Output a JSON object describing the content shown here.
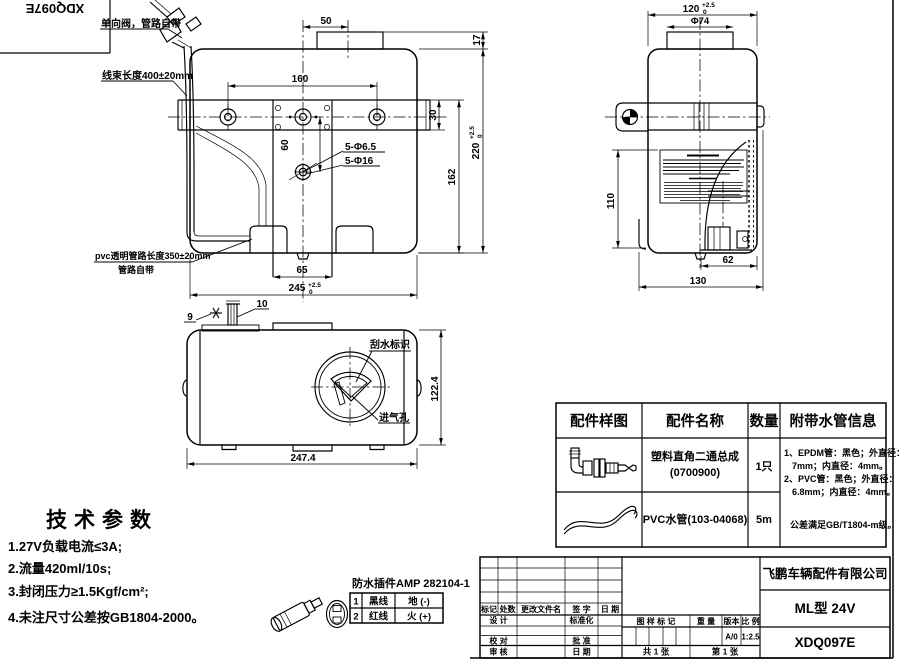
{
  "drawing": {
    "flipped_number": "XDQ097E"
  },
  "callouts": {
    "check_valve": "单向阀，管路自带",
    "harness_length": "线束长度400±20mm",
    "pvc_pipe_line1": "pvc透明管路长度350±20mm",
    "pvc_pipe_line2": "管路自带",
    "wiper_mark": "刮水标识",
    "air_vent": "进气孔"
  },
  "dims": {
    "tol_up": "+2.5",
    "tol_dn": "0",
    "front": {
      "cap_offset": "50",
      "cap_height": "17",
      "hole_spacing": "160",
      "bracket_width": "30",
      "plate_hole_spacing": "60",
      "holes_small": "5-Φ6.5",
      "holes_large": "5-Φ16",
      "body_height": "162",
      "total_height": "220",
      "foot_width": "65",
      "total_width": "245"
    },
    "side": {
      "width": "120",
      "cap_dia": "Φ74",
      "pump_height": "110",
      "outlet_offset": "62",
      "base_width": "130"
    },
    "top": {
      "bracket_a": "9",
      "bracket_b": "10",
      "length": "247.4",
      "depth": "122.4"
    }
  },
  "tech": {
    "title": "技术参数",
    "items": [
      "1.27V负载电流≤3A;",
      "2.流量420ml/10s;",
      "3.封闭压力≥1.5Kgf/cm²;",
      "4.未注尺寸公差按GB1804-2000。"
    ]
  },
  "connector": {
    "title": "防水插件AMP 282104-1",
    "pins": [
      {
        "no": "1",
        "wire": "黑线",
        "polarity": "地 (-)"
      },
      {
        "no": "2",
        "wire": "红线",
        "polarity": "火 (+)"
      }
    ]
  },
  "parts": {
    "headers": [
      "配件样图",
      "配件名称",
      "数量",
      "附带水管信息"
    ],
    "rows": [
      {
        "name_line1": "塑料直角二通总成",
        "name_line2": "(0700900)",
        "qty": "1只"
      },
      {
        "name_line1": "PVC水管(103-04068)",
        "name_line2": "",
        "qty": "5m"
      }
    ],
    "hose_info": [
      "1、EPDM管：黑色；外直径：",
      "7mm；内直径：4mm。",
      "2、PVC管：黑色；外直径：",
      "6.8mm；内直径：4mm。",
      "公差满足GB/T1804-m级。"
    ]
  },
  "title_block": {
    "rev_cols": [
      "标记",
      "处数",
      "更改文件名",
      "签 字",
      "日 期"
    ],
    "design": "设 计",
    "standardization": "标准化",
    "check": "校 对",
    "approve": "批 准",
    "audit": "审 核",
    "date_label": "日 期",
    "mark_label": "图 样 标 记",
    "weight_label": "重 量",
    "version_label": "版本",
    "scale_label": "比 例",
    "version": "A/0",
    "scale": "1:2.5",
    "sheets": "共 1 张",
    "sheet_no": "第 1 张",
    "company": "飞鹏车辆配件有限公司",
    "model": "ML型 24V",
    "number": "XDQ097E"
  }
}
